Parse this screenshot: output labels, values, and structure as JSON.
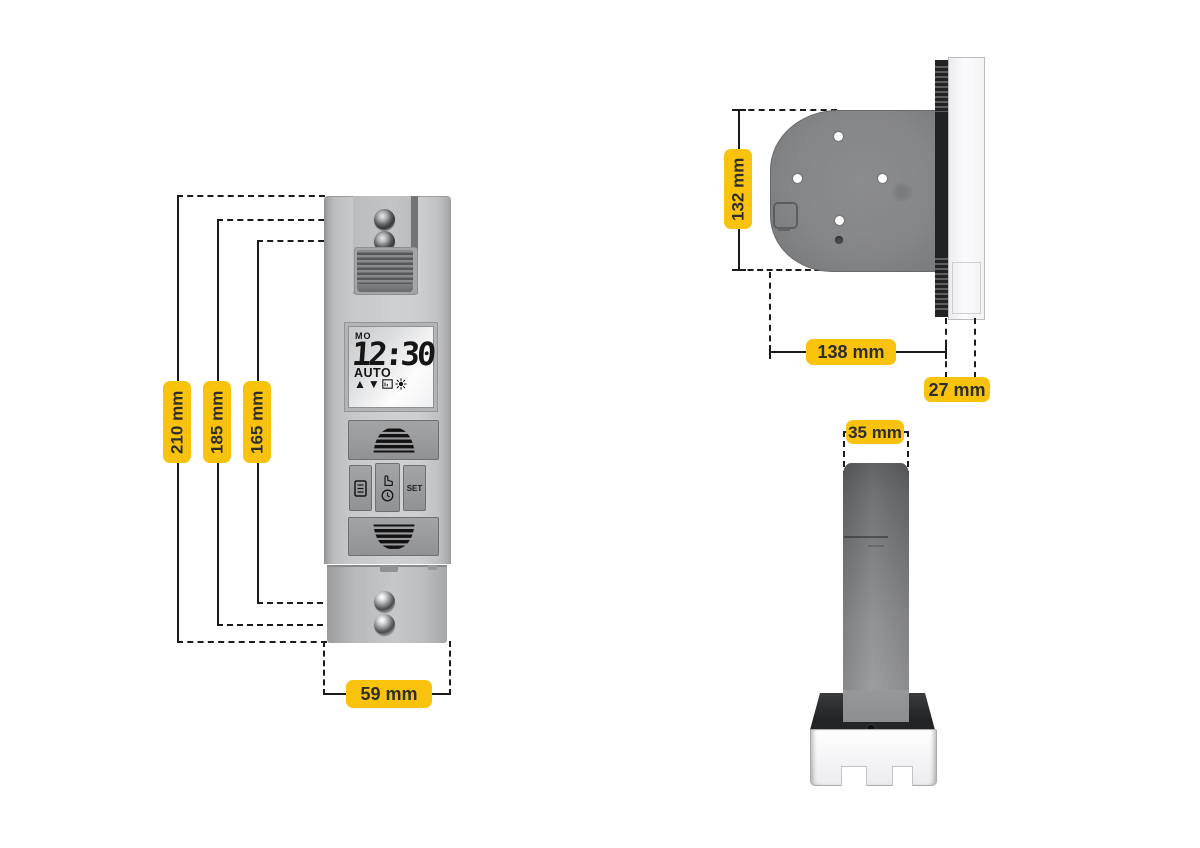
{
  "diagram": {
    "accent_color": "#F8C20D",
    "label_text_color": "#2E2D2B",
    "line_color": "#1B1B1B"
  },
  "front_view": {
    "dimensions": {
      "height_overall": "210 mm",
      "height_outer_holes": "185 mm",
      "height_inner_holes": "165 mm",
      "width": "59 mm"
    },
    "lcd": {
      "day": "MO",
      "time": "12:30",
      "mode": "AUTO",
      "status_icons": [
        "up-triangle-icon",
        "down-triangle-icon",
        "program-icon",
        "sun-icon"
      ],
      "glyphs": {
        "up": "▲",
        "down": "▼"
      }
    },
    "buttons": {
      "up_icon": "shutter-up-icon",
      "menu_icon": "menu-icon",
      "manual_icons": [
        "hand-icon",
        "clock-icon"
      ],
      "set_label": "SET",
      "down_icon": "shutter-down-icon"
    }
  },
  "side_view": {
    "dimensions": {
      "height": "132 mm",
      "depth": "138 mm",
      "front_panel_depth": "27 mm"
    }
  },
  "top_view": {
    "dimensions": {
      "width": "35 mm"
    }
  }
}
